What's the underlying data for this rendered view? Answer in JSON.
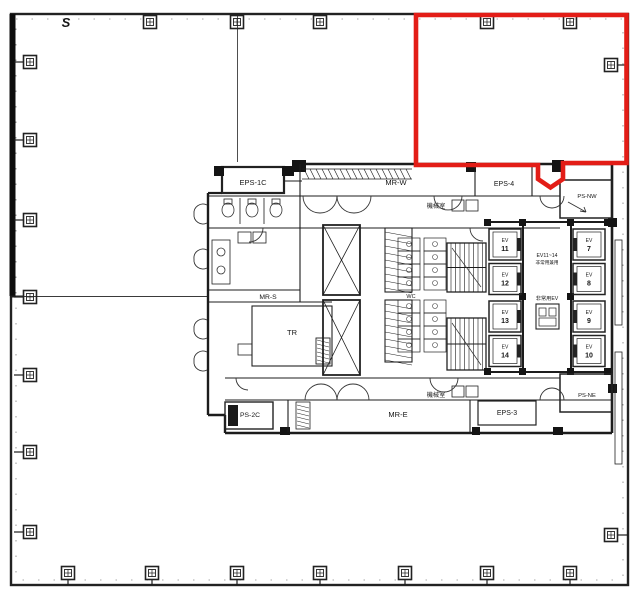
{
  "plan": {
    "section_marker": "S",
    "highlight_color": "#e31d17",
    "rooms": {
      "eps_1c": "EPS-1C",
      "mr_w": "MR-W",
      "eps_4": "EPS-4",
      "ps_nw": "PS-NW",
      "machine_top": "機械室",
      "machine_bottom": "機械室",
      "mr_s": "MR-S",
      "tr": "TR",
      "wc": "WC",
      "ps_2c": "PS-2C",
      "mr_e": "MR-E",
      "eps_3": "EPS-3",
      "ps_ne": "PS-NE"
    },
    "ev_prefix": "EV",
    "elevators_west": [
      "11",
      "12",
      "13",
      "14"
    ],
    "elevators_east": [
      "7",
      "8",
      "9",
      "10"
    ],
    "ev_note_line1": "EV11~14",
    "ev_note_line2": "非常用兼用",
    "emergency_ev_label": "非常用EV"
  }
}
